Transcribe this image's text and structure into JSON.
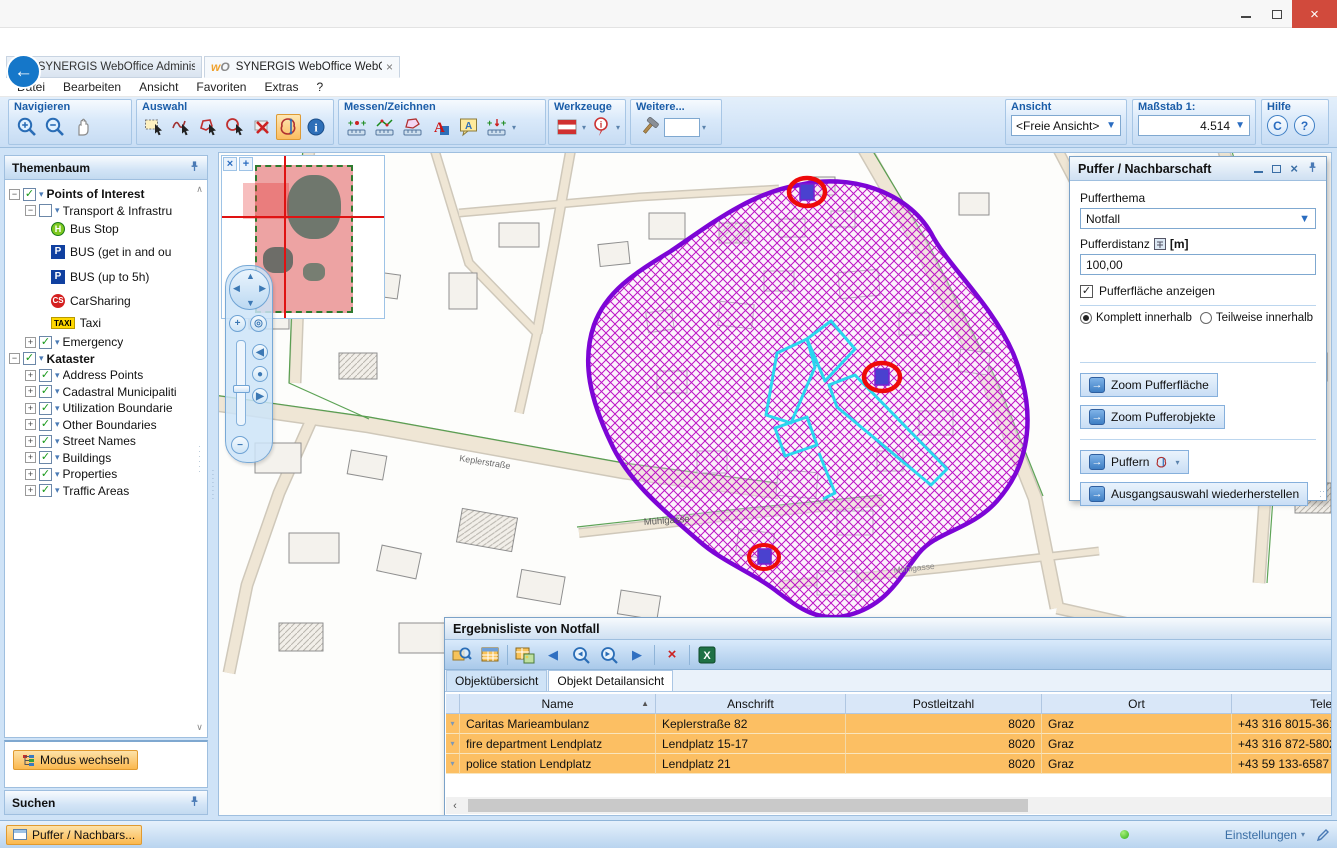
{
  "browser": {
    "favicon_w": "w",
    "favicon_o": "O",
    "url_prefix": "http://",
    "url_host": "w-ws-rainer",
    "url_rest": ":8080/WebOffice/synserver?project=WebOffice_SampleProject&language=de",
    "tabs": [
      {
        "label": "SYNERGIS WebOffice Administ..."
      },
      {
        "label": "SYNERGIS WebOffice WebO..."
      }
    ],
    "menu": [
      "Datei",
      "Bearbeiten",
      "Ansicht",
      "Favoriten",
      "Extras",
      "?"
    ]
  },
  "toolbar": {
    "navigieren_title": "Navigieren",
    "auswahl_title": "Auswahl",
    "messen_title": "Messen/Zeichnen",
    "werkzeuge_title": "Werkzeuge",
    "weitere_title": "Weitere...",
    "ansicht_title": "Ansicht",
    "ansicht_value": "<Freie Ansicht>",
    "massstab_title": "Maßstab 1:",
    "massstab_value": "4.514",
    "hilfe_title": "Hilfe",
    "hilfe_c": "C",
    "hilfe_q": "?"
  },
  "sidebar": {
    "themenbaum_title": "Themenbaum",
    "tree": [
      {
        "label": "Points of Interest"
      },
      {
        "label": "Transport & Infrastru"
      },
      {
        "label": "Bus Stop",
        "badge": "H"
      },
      {
        "label": "BUS (get in and ou",
        "badge": "P"
      },
      {
        "label": "BUS (up to 5h)",
        "badge": "P"
      },
      {
        "label": "CarSharing",
        "badge": "CS"
      },
      {
        "label": "Taxi",
        "badge": "TAXI"
      },
      {
        "label": "Emergency"
      },
      {
        "label": "Kataster"
      },
      {
        "label": "Address Points"
      },
      {
        "label": "Cadastral Municipaliti"
      },
      {
        "label": "Utilization Boundarie"
      },
      {
        "label": "Other Boundaries"
      },
      {
        "label": "Street Names"
      },
      {
        "label": "Buildings"
      },
      {
        "label": "Properties"
      },
      {
        "label": "Traffic Areas"
      }
    ],
    "modus_button": "Modus wechseln",
    "suchen_title": "Suchen"
  },
  "map": {
    "labels": {
      "muehlgasse": "Mühlgasse",
      "muehlgasse2": "Mühlgasse",
      "keplerstrasse": "Keplerstraße"
    }
  },
  "buffer_panel": {
    "title": "Puffer / Nachbarschaft",
    "pufferthema_label": "Pufferthema",
    "pufferthema_value": "Notfall",
    "pufferdistanz_label": "Pufferdistanz",
    "pufferdistanz_unit": "[m]",
    "pufferdistanz_value": "100,00",
    "show_area_label": "Pufferfläche anzeigen",
    "radio_complete": "Komplett innerhalb",
    "radio_partial": "Teilweise innerhalb",
    "btn_zoom_area": "Zoom Pufferfläche",
    "btn_zoom_objects": "Zoom Pufferobjekte",
    "btn_buffer": "Puffern",
    "btn_restore": "Ausgangsauswahl wiederherstellen"
  },
  "results_panel": {
    "title": "Ergebnisliste von Notfall",
    "status": "3 von 3 Objekten ausgewählt",
    "tabs": [
      "Objektübersicht",
      "Objekt Detailansicht"
    ],
    "table": {
      "columns": [
        "Name",
        "Anschrift",
        "Postleitzahl",
        "Ort",
        "Telefon",
        "Straße"
      ],
      "rows": [
        [
          "Caritas Marieambulanz",
          "Keplerstraße 82",
          "8020",
          "Graz",
          "+43 316 8015-361",
          "Keplerstraße"
        ],
        [
          "fire department Lendplatz",
          "Lendplatz 15-17",
          "8020",
          "Graz",
          "+43 316 872-5802",
          "Lendplatz"
        ],
        [
          "police station Lendplatz",
          "Lendplatz 21",
          "8020",
          "Graz",
          "+43 59 133-6587 100",
          "Lendplatz"
        ]
      ]
    }
  },
  "taskbar": {
    "window_button": "Puffer / Nachbars...",
    "settings_label": "Einstellungen"
  }
}
